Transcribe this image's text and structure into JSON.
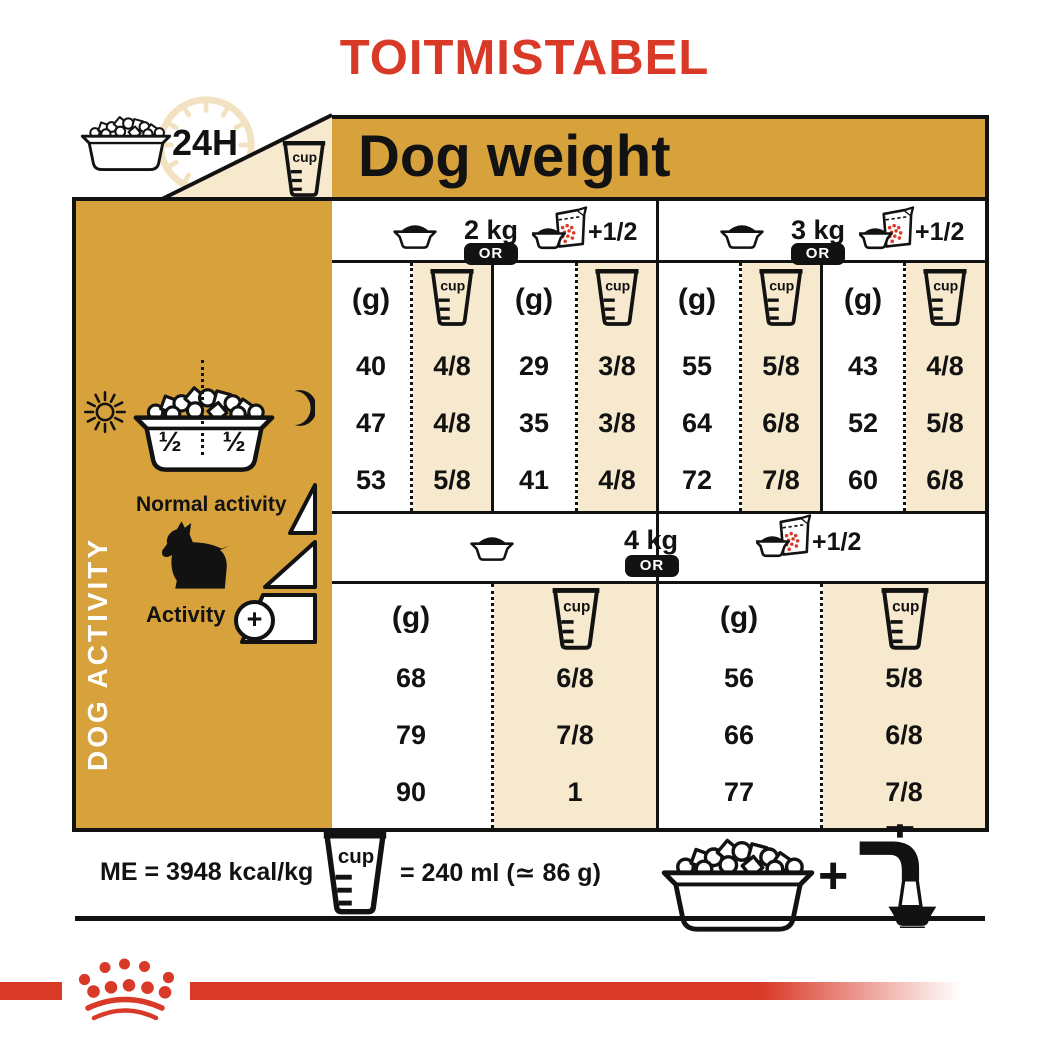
{
  "colors": {
    "red": "#D93A28",
    "gold": "#D7A23C",
    "beige": "#F7E9CE",
    "ink": "#121212",
    "clock_ring": "#F3E2C1"
  },
  "title": "TOITMISTABEL",
  "header": {
    "hours_label": "24H",
    "dog_weight": "Dog weight"
  },
  "labels": {
    "g": "(g)",
    "cup": "cup",
    "or": "OR",
    "plus_half": "+1/2"
  },
  "table": {
    "w2": {
      "label": "2 kg",
      "grams": [
        "40",
        "47",
        "53"
      ],
      "cups": [
        "4/8",
        "4/8",
        "5/8"
      ]
    },
    "w2_supplement": {
      "grams": [
        "29",
        "35",
        "41"
      ],
      "cups": [
        "3/8",
        "3/8",
        "4/8"
      ]
    },
    "w3": {
      "label": "3 kg",
      "grams": [
        "55",
        "64",
        "72"
      ],
      "cups": [
        "5/8",
        "6/8",
        "7/8"
      ]
    },
    "w3_supplement": {
      "grams": [
        "43",
        "52",
        "60"
      ],
      "cups": [
        "4/8",
        "5/8",
        "6/8"
      ]
    },
    "w4": {
      "label": "4 kg",
      "grams": [
        "68",
        "79",
        "90"
      ],
      "cups": [
        "6/8",
        "7/8",
        "1"
      ]
    },
    "w4_supplement": {
      "grams": [
        "56",
        "66",
        "77"
      ],
      "cups": [
        "5/8",
        "6/8",
        "7/8"
      ]
    }
  },
  "sidebar": {
    "vertical_label": "DOG ACTIVITY",
    "half_left": "½",
    "half_right": "½",
    "normal_activity": "Normal activity",
    "activity": "Activity",
    "activity_plus": "+"
  },
  "footer": {
    "me": "ME = 3948 kcal/kg",
    "cup_equals": "= 240 ml (≃ 86 g)",
    "plus": "+"
  }
}
